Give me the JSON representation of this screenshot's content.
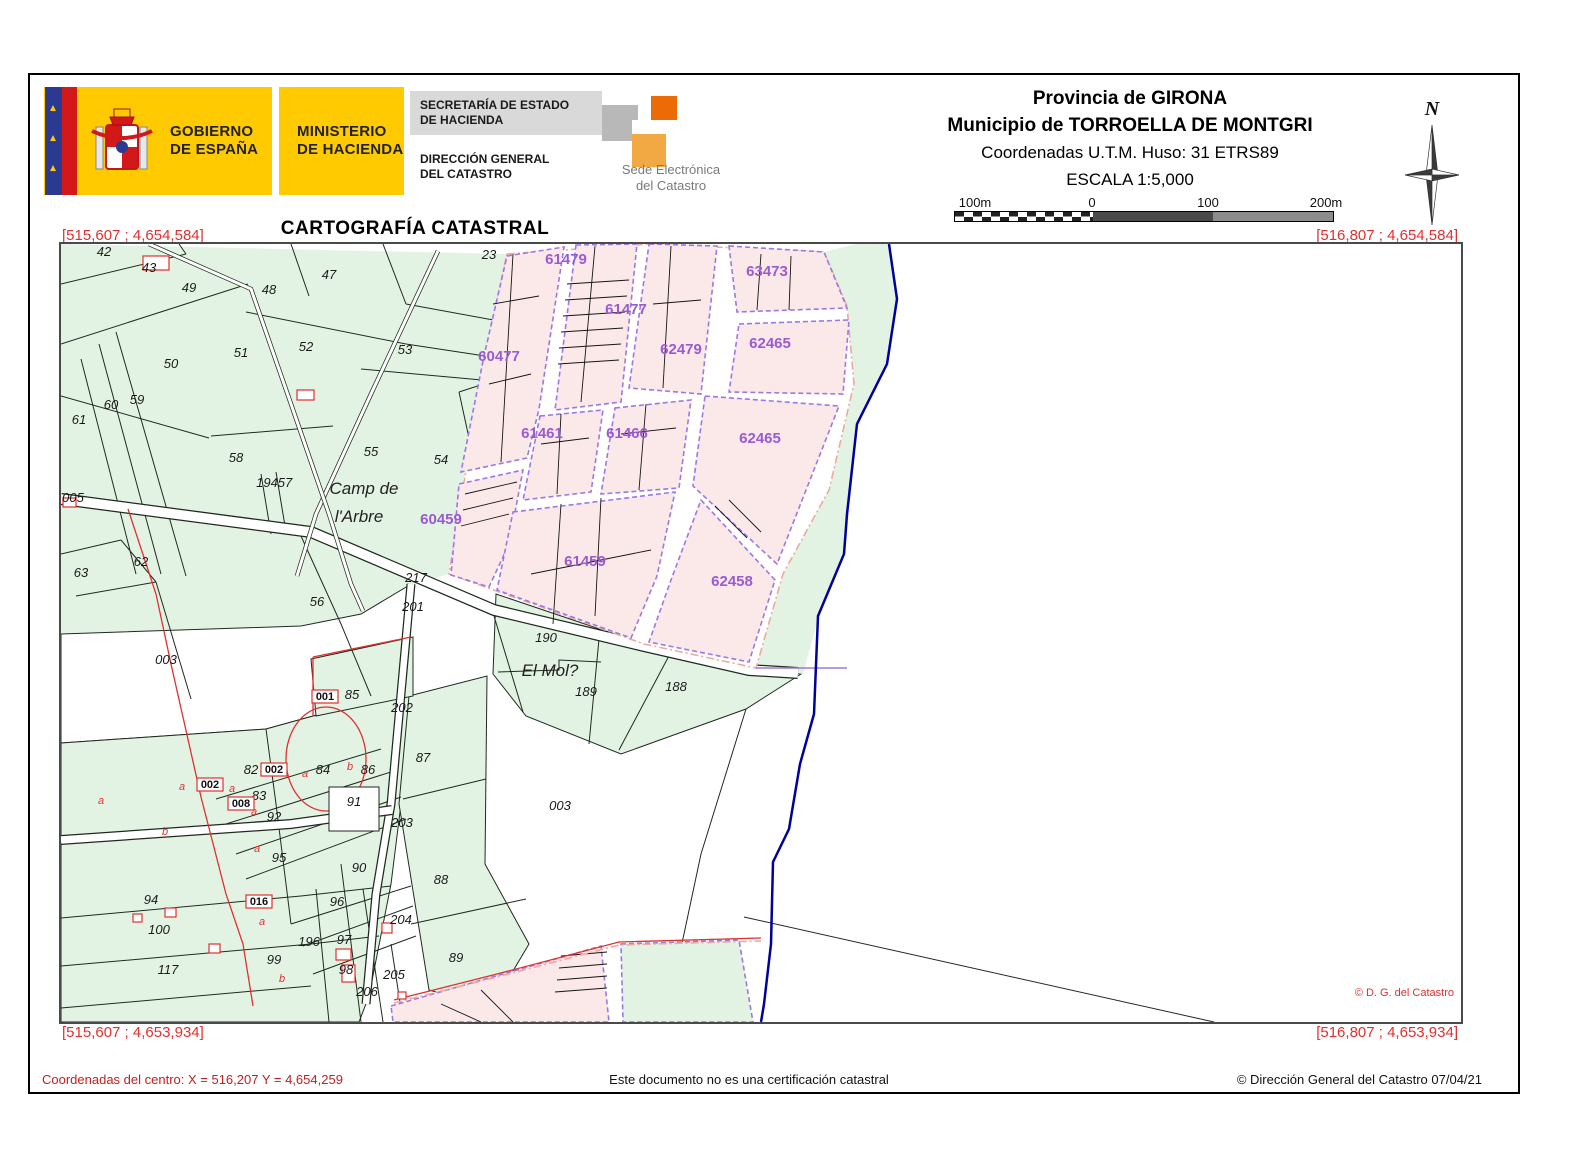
{
  "header": {
    "logo": {
      "gobierno_line1": "GOBIERNO",
      "gobierno_line2": "DE ESPAÑA",
      "ministerio_line1": "MINISTERIO",
      "ministerio_line2": "DE HACIENDA",
      "secretaria_line1": "SECRETARÍA DE ESTADO",
      "secretaria_line2": "DE HACIENDA",
      "direccion_line1": "DIRECCIÓN GENERAL",
      "direccion_line2": "DEL CATASTRO",
      "sede_line1": "Sede Electrónica",
      "sede_line2": "del Catastro"
    },
    "provincia": "Provincia de GIRONA",
    "municipio": "Municipio de TORROELLA DE MONTGRI",
    "utm": "Coordenadas U.T.M. Huso: 31 ETRS89",
    "escala": "ESCALA 1:5,000",
    "scalebar": {
      "labels": [
        "100m",
        "0",
        "100",
        "200m"
      ]
    },
    "compass_n": "N"
  },
  "title": "CARTOGRAFÍA CATASTRAL",
  "map": {
    "corners": {
      "tl": "[515,607 ; 4,654,584]",
      "tr": "[516,807 ; 4,654,584]",
      "bl": "[515,607 ; 4,653,934]",
      "br": "[516,807 ; 4,653,934]"
    },
    "copyright": "© D. G. del Catastro",
    "colors": {
      "rural_fill": "#e3f3e3",
      "urban_fill": "#fbe9e9",
      "urban_border": "#9b79e0",
      "river": "#00009b",
      "red": "#e03030",
      "coord_text": "#e03030",
      "urban_label": "#9a5ad0"
    },
    "places": [
      {
        "t": "Camp de",
        "x": 303,
        "y": 250
      },
      {
        "t": "l'Arbre",
        "x": 298,
        "y": 278
      },
      {
        "t": "El Mol?",
        "x": 489,
        "y": 432
      }
    ],
    "rural_parcels": [
      {
        "n": "42",
        "x": 43,
        "y": 12
      },
      {
        "n": "43",
        "x": 88,
        "y": 28
      },
      {
        "n": "49",
        "x": 128,
        "y": 48
      },
      {
        "n": "48",
        "x": 208,
        "y": 50
      },
      {
        "n": "47",
        "x": 268,
        "y": 35
      },
      {
        "n": "23",
        "x": 428,
        "y": 15
      },
      {
        "n": "50",
        "x": 110,
        "y": 124
      },
      {
        "n": "51",
        "x": 180,
        "y": 113
      },
      {
        "n": "52",
        "x": 245,
        "y": 107
      },
      {
        "n": "53",
        "x": 344,
        "y": 110
      },
      {
        "n": "60",
        "x": 50,
        "y": 165
      },
      {
        "n": "59",
        "x": 76,
        "y": 160
      },
      {
        "n": "61",
        "x": 18,
        "y": 180
      },
      {
        "n": "58",
        "x": 175,
        "y": 218
      },
      {
        "n": "55",
        "x": 310,
        "y": 212
      },
      {
        "n": "54",
        "x": 380,
        "y": 220
      },
      {
        "n": "194",
        "x": 206,
        "y": 243
      },
      {
        "n": "57",
        "x": 224,
        "y": 243
      },
      {
        "n": "005",
        "x": 12,
        "y": 258
      },
      {
        "n": "62",
        "x": 80,
        "y": 322
      },
      {
        "n": "63",
        "x": 20,
        "y": 333
      },
      {
        "n": "56",
        "x": 256,
        "y": 362
      },
      {
        "n": "217",
        "x": 355,
        "y": 338
      },
      {
        "n": "201",
        "x": 352,
        "y": 367
      },
      {
        "n": "190",
        "x": 485,
        "y": 398
      },
      {
        "n": "189",
        "x": 525,
        "y": 452
      },
      {
        "n": "188",
        "x": 615,
        "y": 447
      },
      {
        "n": "202",
        "x": 341,
        "y": 468
      },
      {
        "n": "003",
        "x": 105,
        "y": 420
      },
      {
        "n": "85",
        "x": 291,
        "y": 455
      },
      {
        "n": "87",
        "x": 362,
        "y": 518
      },
      {
        "n": "84",
        "x": 262,
        "y": 530
      },
      {
        "n": "86",
        "x": 307,
        "y": 530
      },
      {
        "n": "82",
        "x": 190,
        "y": 530
      },
      {
        "n": "83",
        "x": 198,
        "y": 556
      },
      {
        "n": "91",
        "x": 293,
        "y": 562
      },
      {
        "n": "92",
        "x": 213,
        "y": 577
      },
      {
        "n": "95",
        "x": 218,
        "y": 618
      },
      {
        "n": "90",
        "x": 298,
        "y": 628
      },
      {
        "n": "94",
        "x": 90,
        "y": 660
      },
      {
        "n": "96",
        "x": 276,
        "y": 662
      },
      {
        "n": "196",
        "x": 248,
        "y": 702
      },
      {
        "n": "97",
        "x": 283,
        "y": 700
      },
      {
        "n": "99",
        "x": 213,
        "y": 720
      },
      {
        "n": "98",
        "x": 285,
        "y": 730
      },
      {
        "n": "100",
        "x": 98,
        "y": 690
      },
      {
        "n": "117",
        "x": 107,
        "y": 730
      },
      {
        "n": "204",
        "x": 340,
        "y": 680
      },
      {
        "n": "203",
        "x": 341,
        "y": 583
      },
      {
        "n": "205",
        "x": 333,
        "y": 735
      },
      {
        "n": "206",
        "x": 306,
        "y": 752
      },
      {
        "n": "88",
        "x": 380,
        "y": 640
      },
      {
        "n": "89",
        "x": 395,
        "y": 718
      },
      {
        "n": "003",
        "x": 499,
        "y": 566
      }
    ],
    "urban_parcels": [
      {
        "n": "61479",
        "x": 505,
        "y": 20
      },
      {
        "n": "63473",
        "x": 706,
        "y": 32
      },
      {
        "n": "61477",
        "x": 565,
        "y": 70
      },
      {
        "n": "62479",
        "x": 620,
        "y": 110
      },
      {
        "n": "62465",
        "x": 709,
        "y": 104
      },
      {
        "n": "60477",
        "x": 438,
        "y": 117
      },
      {
        "n": "61461",
        "x": 481,
        "y": 194
      },
      {
        "n": "61466",
        "x": 566,
        "y": 194
      },
      {
        "n": "62465",
        "x": 699,
        "y": 199
      },
      {
        "n": "60459",
        "x": 380,
        "y": 280
      },
      {
        "n": "61459",
        "x": 524,
        "y": 322
      },
      {
        "n": "62458",
        "x": 671,
        "y": 342
      }
    ],
    "boxed_labels": [
      {
        "n": "001",
        "x": 264,
        "y": 456
      },
      {
        "n": "002",
        "x": 149,
        "y": 544
      },
      {
        "n": "002",
        "x": 213,
        "y": 529
      },
      {
        "n": "008",
        "x": 180,
        "y": 563
      },
      {
        "n": "016",
        "x": 198,
        "y": 661
      }
    ],
    "letters": [
      {
        "n": "a",
        "x": 40,
        "y": 560
      },
      {
        "n": "a",
        "x": 121,
        "y": 546
      },
      {
        "n": "a",
        "x": 171,
        "y": 548
      },
      {
        "n": "a",
        "x": 244,
        "y": 533
      },
      {
        "n": "b",
        "x": 289,
        "y": 526
      },
      {
        "n": "a",
        "x": 193,
        "y": 571
      },
      {
        "n": "a",
        "x": 196,
        "y": 608
      },
      {
        "n": "b",
        "x": 104,
        "y": 591
      },
      {
        "n": "a",
        "x": 201,
        "y": 681
      },
      {
        "n": "b",
        "x": 221,
        "y": 738
      }
    ]
  },
  "footer": {
    "center_coords": "Coordenadas del centro: X = 516,207 Y = 4,654,259",
    "disclaimer": "Este documento no es una certificación catastral",
    "copyright": "© Dirección General del Catastro 07/04/21"
  }
}
